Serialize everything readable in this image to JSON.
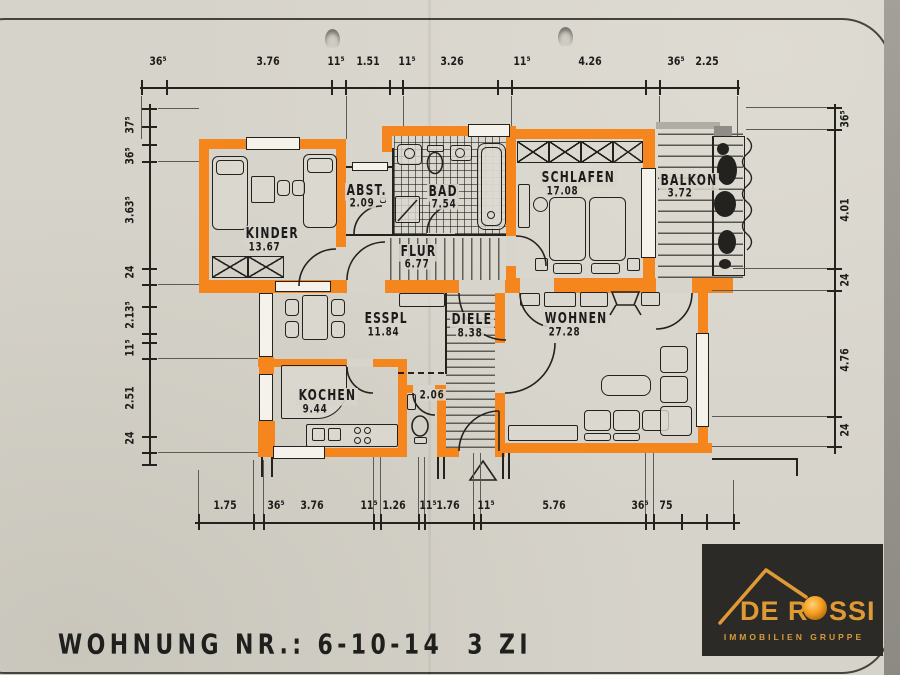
{
  "page": {
    "width": 900,
    "height": 675
  },
  "title": {
    "label": "WOHNUNG NR.: 6-10-14  3 ZI"
  },
  "logo": {
    "brand_de": "DE",
    "brand_r": "R",
    "brand_ssi": "SSI",
    "tagline": "IMMOBILIEN GRUPPE"
  },
  "rooms": {
    "kinder": {
      "name": "KINDER",
      "area": "13.67"
    },
    "abst": {
      "name": "ABST.",
      "area": "2.09"
    },
    "bad": {
      "name": "BAD",
      "area": "7.54"
    },
    "flur": {
      "name": "FLUR",
      "area": "6.77"
    },
    "schlafen": {
      "name": "SCHLAFEN",
      "area": "17.08"
    },
    "balkon": {
      "name": "BALKON",
      "area": "3.72"
    },
    "esspl": {
      "name": "ESSPL",
      "area": "11.84"
    },
    "diele": {
      "name": "DIELE",
      "area": "8.38"
    },
    "wohnen": {
      "name": "WOHNEN",
      "area": "27.28"
    },
    "kochen": {
      "name": "KOCHEN",
      "area": "9.44"
    },
    "wc": {
      "area": "2.06"
    }
  },
  "dimensions": {
    "top": [
      "36⁵",
      "3.76",
      "11⁵",
      "1.51",
      "11⁵",
      "3.26",
      "11⁵",
      "4.26",
      "36⁵",
      "2.25"
    ],
    "bottom": [
      "1.75",
      "36⁵",
      "3.76",
      "11⁵",
      "1.26",
      "11⁵",
      "1.76",
      "11⁵",
      "5.76",
      "36⁵",
      "75"
    ],
    "left": [
      "37⁵",
      "36⁵",
      "3.63⁵",
      "24",
      "2.13⁵",
      "11⁵",
      "2.51",
      "24"
    ],
    "right": [
      "36⁵",
      "4.01",
      "24",
      "4.76",
      "24"
    ]
  },
  "colors": {
    "wall": "#F5861D",
    "paper": "#D6D3CA",
    "ink": "#23221F",
    "logo_bg": "#2B2A27",
    "logo_gold": "#E09A35"
  }
}
